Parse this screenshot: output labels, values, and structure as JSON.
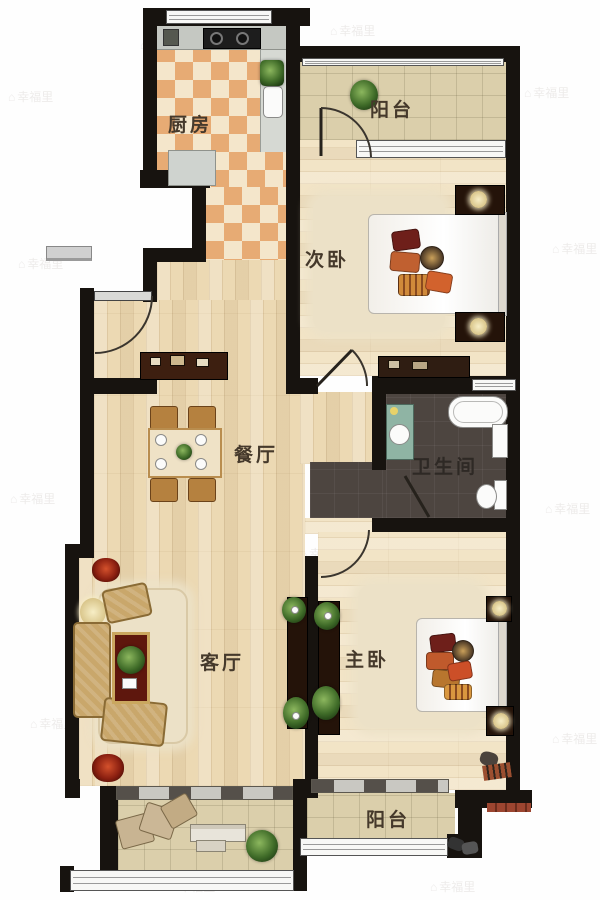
{
  "watermark": {
    "icon_glyph": "⌂",
    "text": "幸福里"
  },
  "rooms": {
    "kitchen": {
      "label": "厨房"
    },
    "balcony_top": {
      "label": "阳台"
    },
    "bedroom_second": {
      "label": "次卧"
    },
    "dining": {
      "label": "餐厅"
    },
    "bathroom": {
      "label": "卫生间"
    },
    "living": {
      "label": "客厅"
    },
    "bedroom_master": {
      "label": "主卧"
    },
    "balcony_bottom": {
      "label": "阳台"
    }
  },
  "colors": {
    "wall": "#17130f",
    "wood_main": "#ecd9b3",
    "wood_bedroom": "#f2e4c6",
    "kitchen_tile_orange": "#e7ab74",
    "kitchen_tile_cream": "#f4e6cb",
    "balcony_tile": "#dbcfab",
    "bathroom_floor": "#4d4540",
    "label_text": "#45392b",
    "sofa_gold": "#c9a76b",
    "accent_red": "#8a1f10"
  }
}
